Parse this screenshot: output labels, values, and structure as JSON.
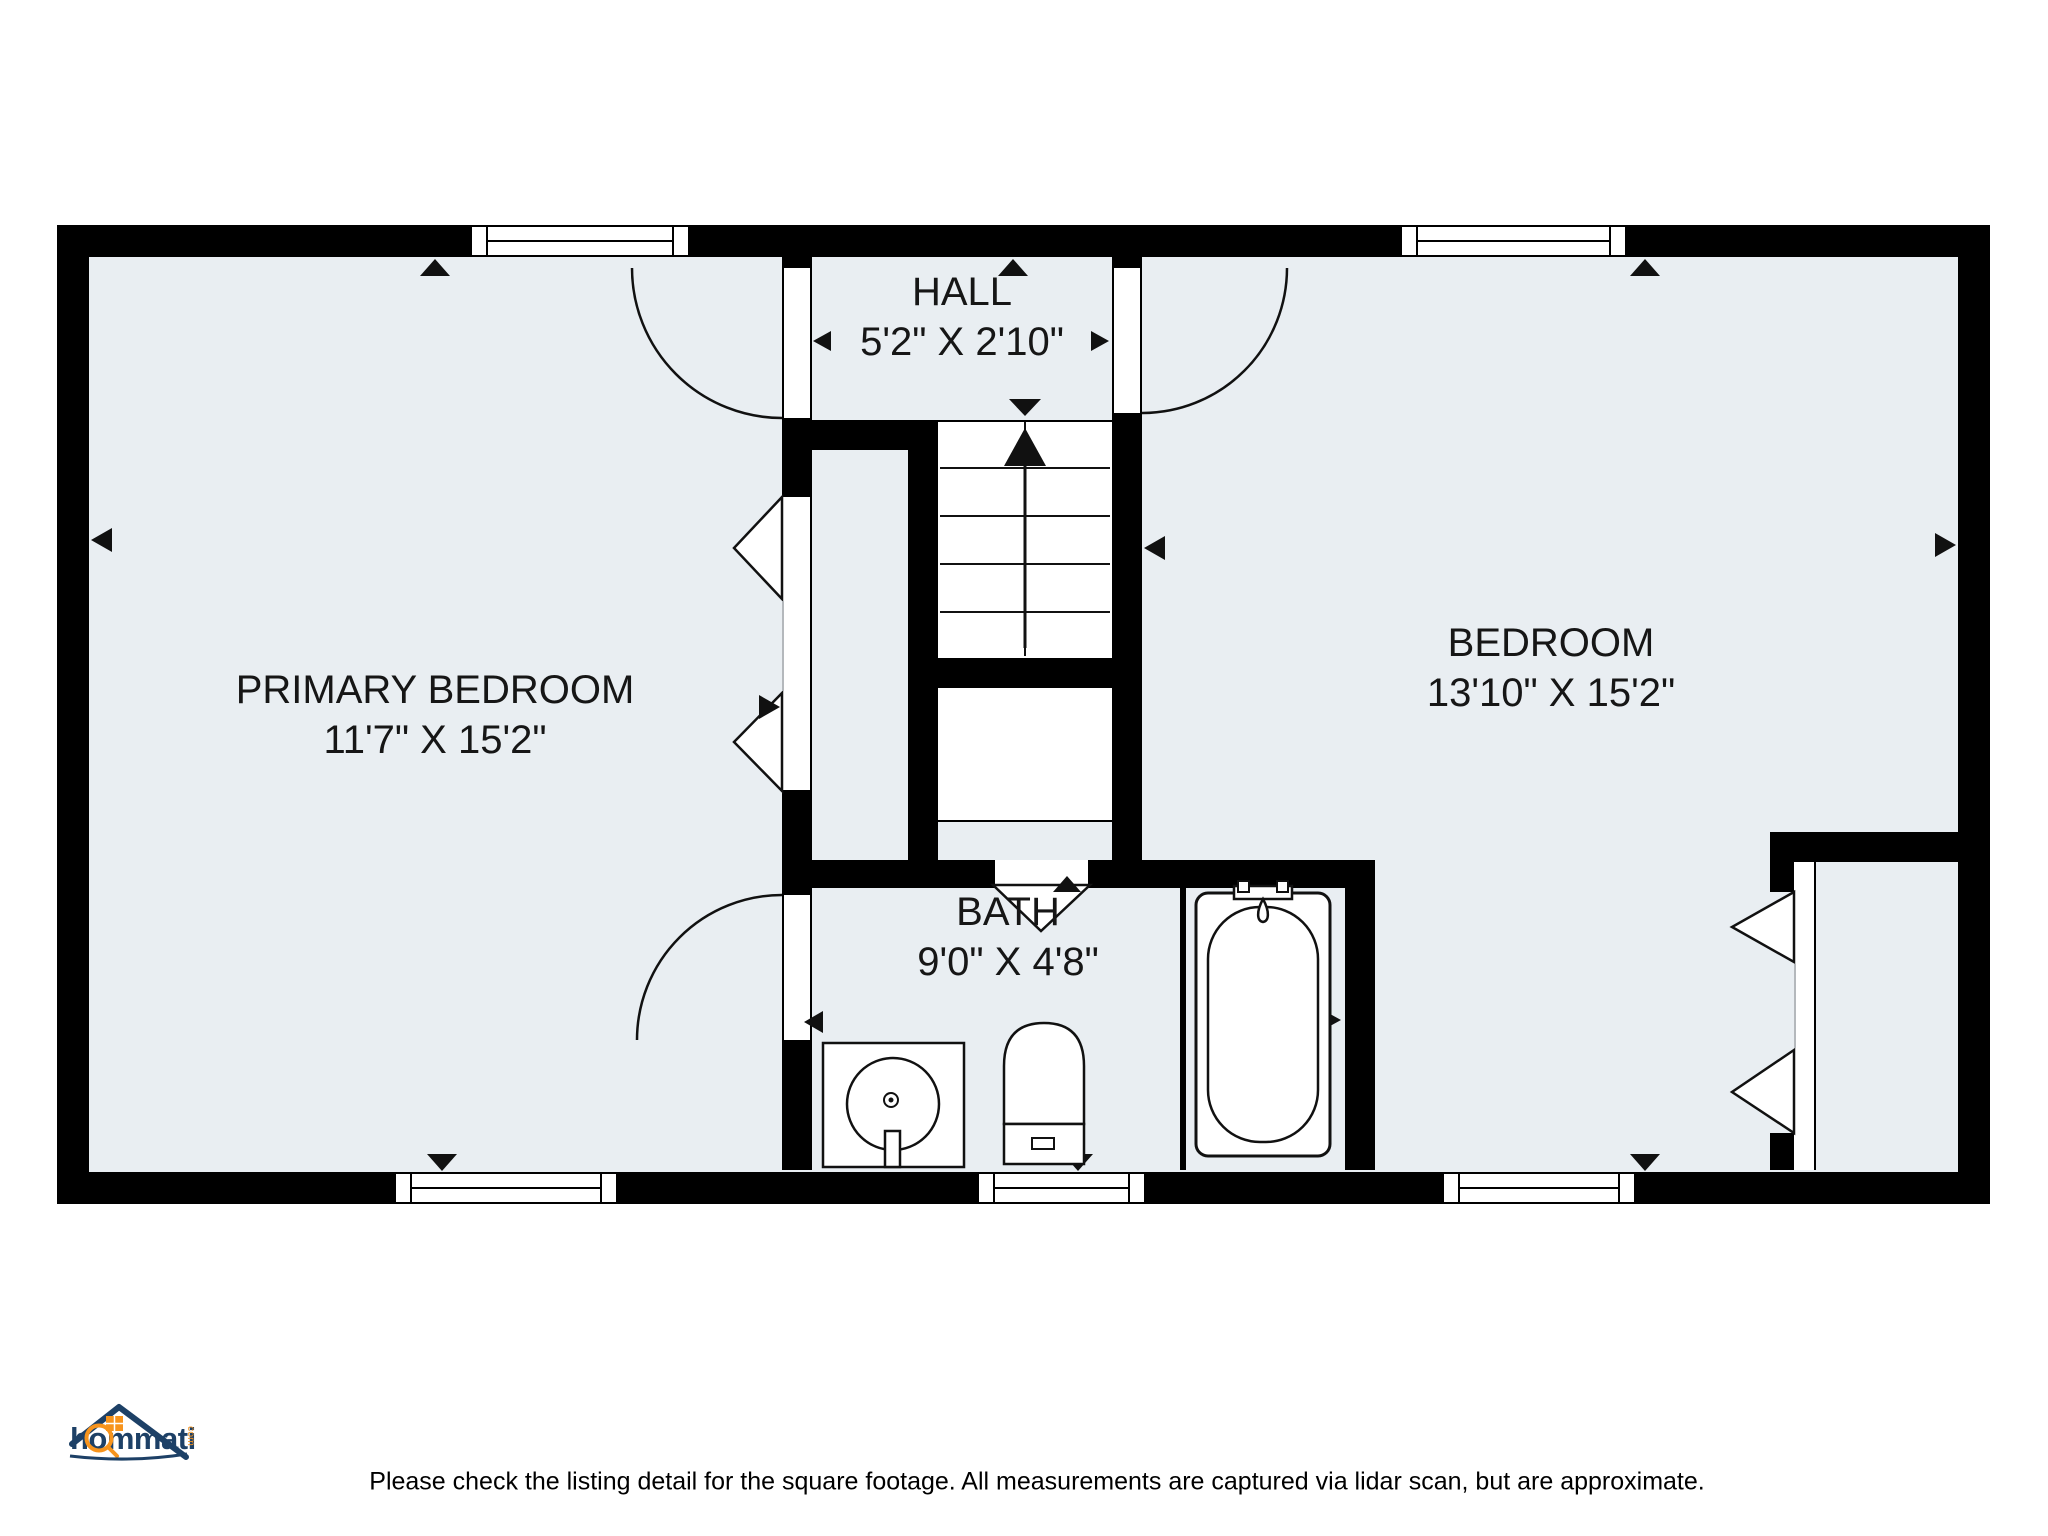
{
  "rooms": [
    {
      "name": "PRIMARY BEDROOM",
      "dims": "11'7\" X 15'2\""
    },
    {
      "name": "HALL",
      "dims": "5'2\" X 2'10\""
    },
    {
      "name": "BEDROOM",
      "dims": "13'10\" X 15'2\""
    },
    {
      "name": "BATH",
      "dims": "9'0\" X 4'8\""
    }
  ],
  "fixtures": {
    "stairs": "staircase-up",
    "bathtub": "bathtub",
    "toilet": "toilet",
    "sink": "sink"
  },
  "logo": {
    "brand": "hommati",
    "tld": "com"
  },
  "footer": {
    "disclaimer": "Please check the listing detail for the square footage. All measurements are captured via lidar scan, but are approximate."
  },
  "colors": {
    "floor": "#e9eef2",
    "wall": "#000000",
    "line": "#111111",
    "logo_navy": "#1d4066",
    "logo_orange": "#f7941d"
  }
}
